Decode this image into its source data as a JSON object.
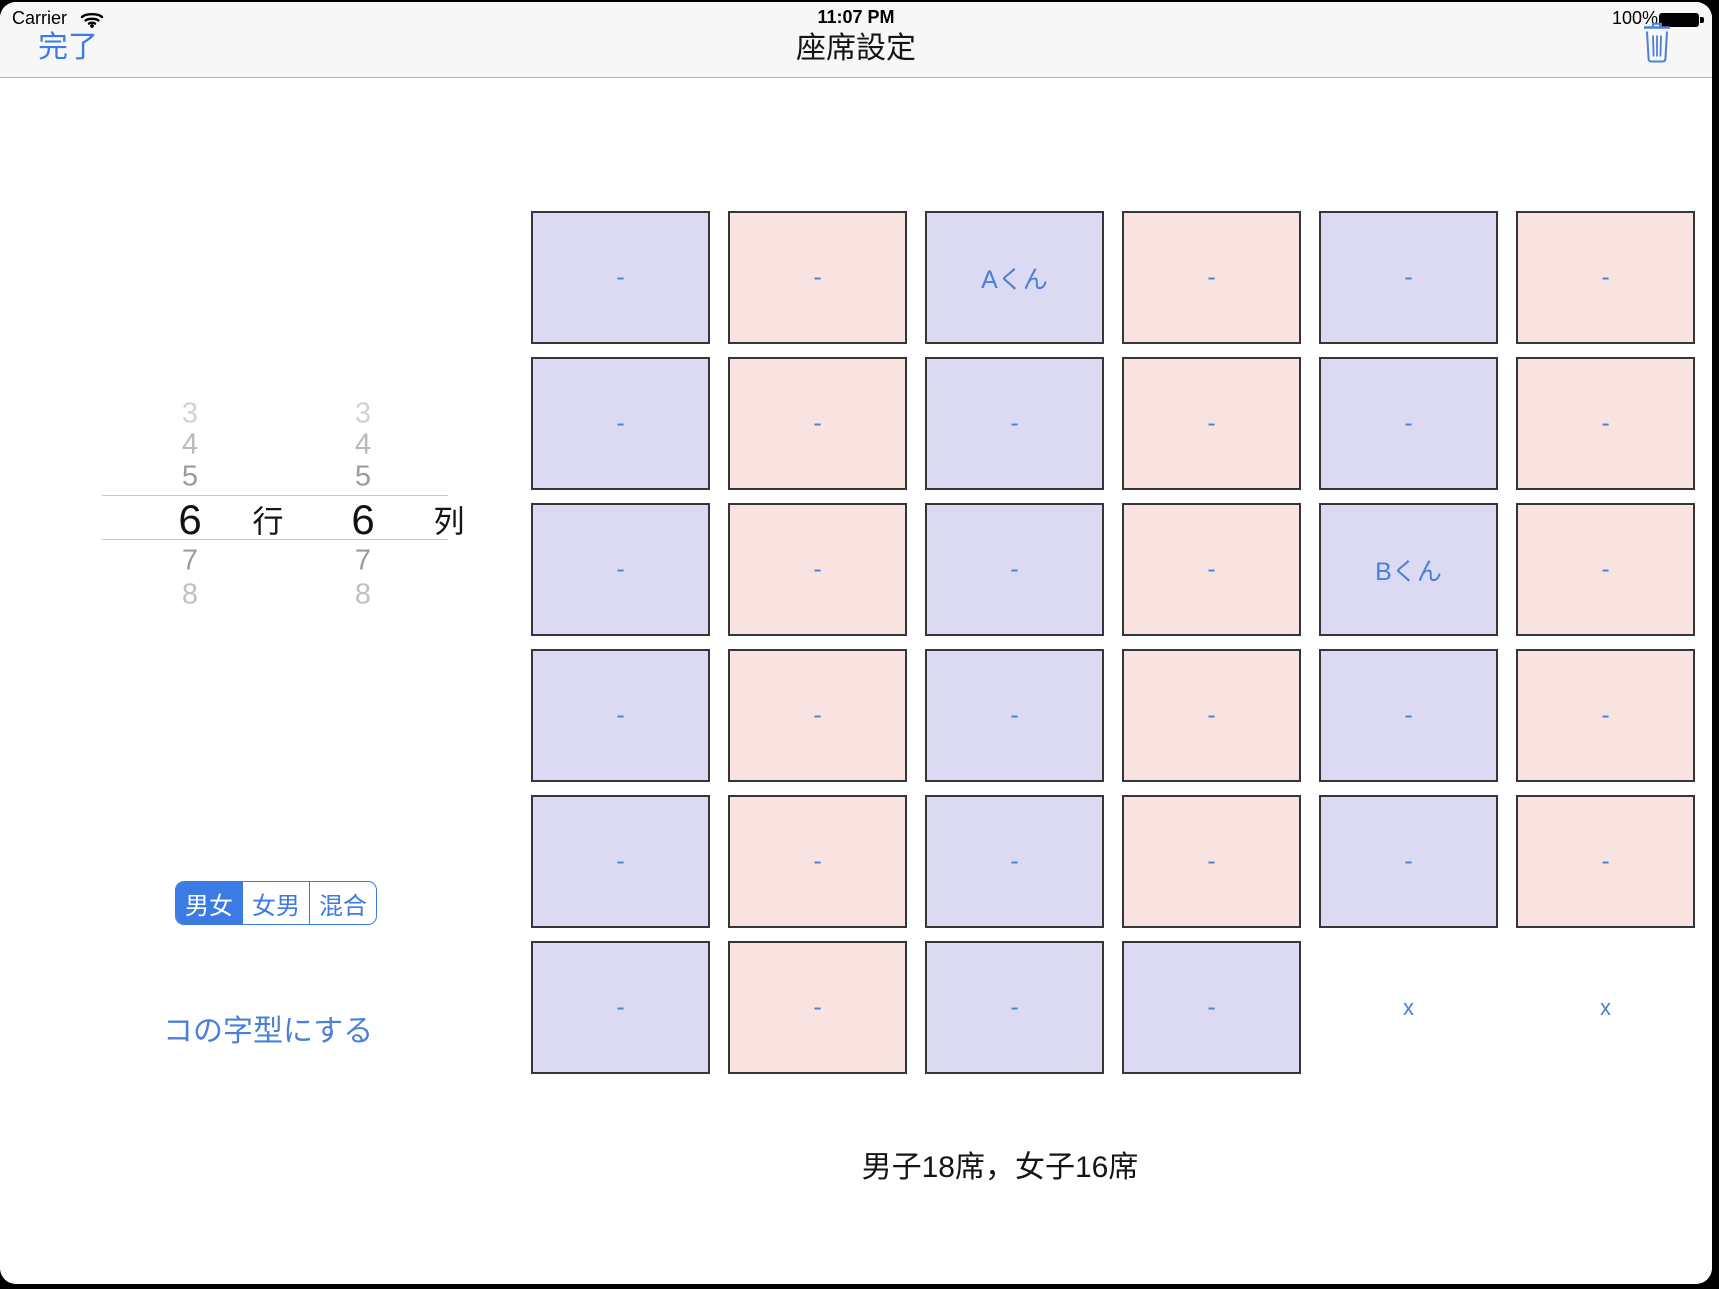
{
  "status_bar": {
    "carrier": "Carrier",
    "time": "11:07 PM",
    "battery_percent": "100%"
  },
  "nav_bar": {
    "done": "完了",
    "title": "座席設定"
  },
  "size_pickers": {
    "row_picker": {
      "options": [
        "3",
        "4",
        "5",
        "6",
        "7",
        "8"
      ],
      "selected": "6",
      "unit": "行"
    },
    "col_picker": {
      "options": [
        "3",
        "4",
        "5",
        "6",
        "7",
        "8"
      ],
      "selected": "6",
      "unit": "列"
    }
  },
  "gender_pattern": {
    "options": [
      "男女",
      "女男",
      "混合"
    ],
    "selected": "男女"
  },
  "u_shape_button": "コの字型にする",
  "seat_grid": {
    "rows": 6,
    "cols": 6,
    "cells": [
      [
        {
          "type": "boy",
          "label": "-"
        },
        {
          "type": "girl",
          "label": "-"
        },
        {
          "type": "boy",
          "label": "Aくん"
        },
        {
          "type": "girl",
          "label": "-"
        },
        {
          "type": "boy",
          "label": "-"
        },
        {
          "type": "girl",
          "label": "-"
        }
      ],
      [
        {
          "type": "boy",
          "label": "-"
        },
        {
          "type": "girl",
          "label": "-"
        },
        {
          "type": "boy",
          "label": "-"
        },
        {
          "type": "girl",
          "label": "-"
        },
        {
          "type": "boy",
          "label": "-"
        },
        {
          "type": "girl",
          "label": "-"
        }
      ],
      [
        {
          "type": "boy",
          "label": "-"
        },
        {
          "type": "girl",
          "label": "-"
        },
        {
          "type": "boy",
          "label": "-"
        },
        {
          "type": "girl",
          "label": "-"
        },
        {
          "type": "boy",
          "label": "Bくん"
        },
        {
          "type": "girl",
          "label": "-"
        }
      ],
      [
        {
          "type": "boy",
          "label": "-"
        },
        {
          "type": "girl",
          "label": "-"
        },
        {
          "type": "boy",
          "label": "-"
        },
        {
          "type": "girl",
          "label": "-"
        },
        {
          "type": "boy",
          "label": "-"
        },
        {
          "type": "girl",
          "label": "-"
        }
      ],
      [
        {
          "type": "boy",
          "label": "-"
        },
        {
          "type": "girl",
          "label": "-"
        },
        {
          "type": "boy",
          "label": "-"
        },
        {
          "type": "girl",
          "label": "-"
        },
        {
          "type": "boy",
          "label": "-"
        },
        {
          "type": "girl",
          "label": "-"
        }
      ],
      [
        {
          "type": "boy",
          "label": "-"
        },
        {
          "type": "girl",
          "label": "-"
        },
        {
          "type": "boy",
          "label": "-"
        },
        {
          "type": "boy",
          "label": "-"
        },
        {
          "type": "removed",
          "label": "x"
        },
        {
          "type": "removed",
          "label": "x"
        }
      ]
    ]
  },
  "summary": "男子18席，女子16席",
  "colors": {
    "accent": "#3c7ae4",
    "seat_text": "#4a80d8",
    "boy_color": "#dcdaf3",
    "girl_color": "#f9e3e1"
  }
}
